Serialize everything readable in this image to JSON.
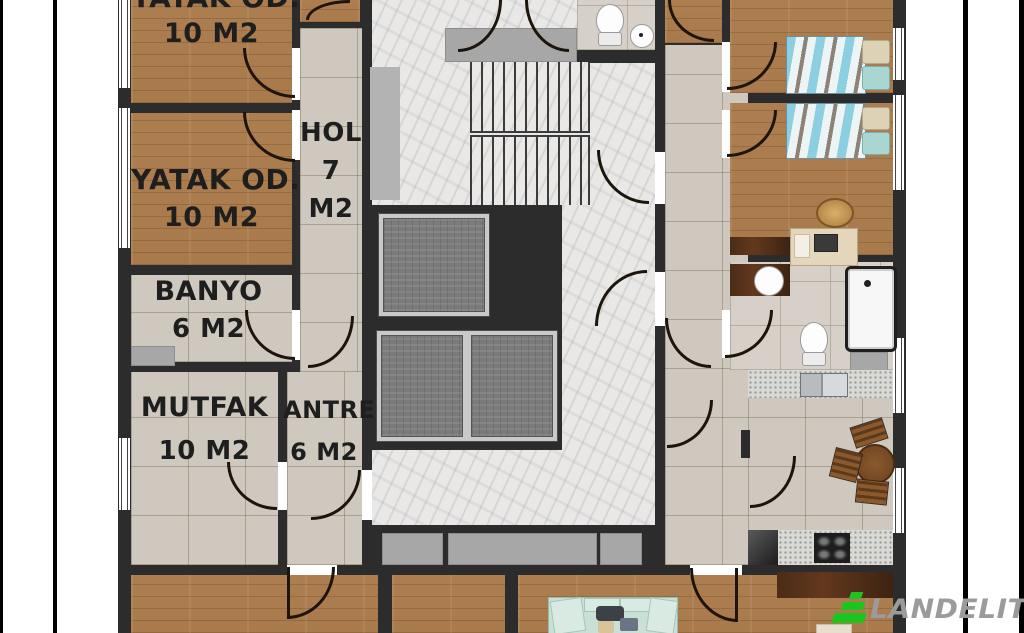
{
  "plan": {
    "title": "apartment floor plan",
    "rooms": {
      "bedroom_top": {
        "name": "YATAK OD.",
        "area": "10 M2"
      },
      "bedroom": {
        "name": "YATAK OD.",
        "area": "10 M2"
      },
      "hol": {
        "name": "HOL",
        "area_value": "7",
        "area_unit": "M2"
      },
      "banyo": {
        "name": "BANYO",
        "area": "6 M2"
      },
      "mutfak": {
        "name": "MUTFAK",
        "area": "10 M2"
      },
      "antre": {
        "name": "ANTRE",
        "area": "6 M2"
      }
    }
  },
  "watermark": {
    "brand": "LANDELITY"
  },
  "colors": {
    "wall": "#2c2c2c",
    "wood_floor": "#a87a4c",
    "tile_floor": "#cfc8be",
    "marble_floor": "#e9e8e6",
    "watermark_green": "#1ec41e",
    "watermark_gray": "#9b9b9b"
  }
}
